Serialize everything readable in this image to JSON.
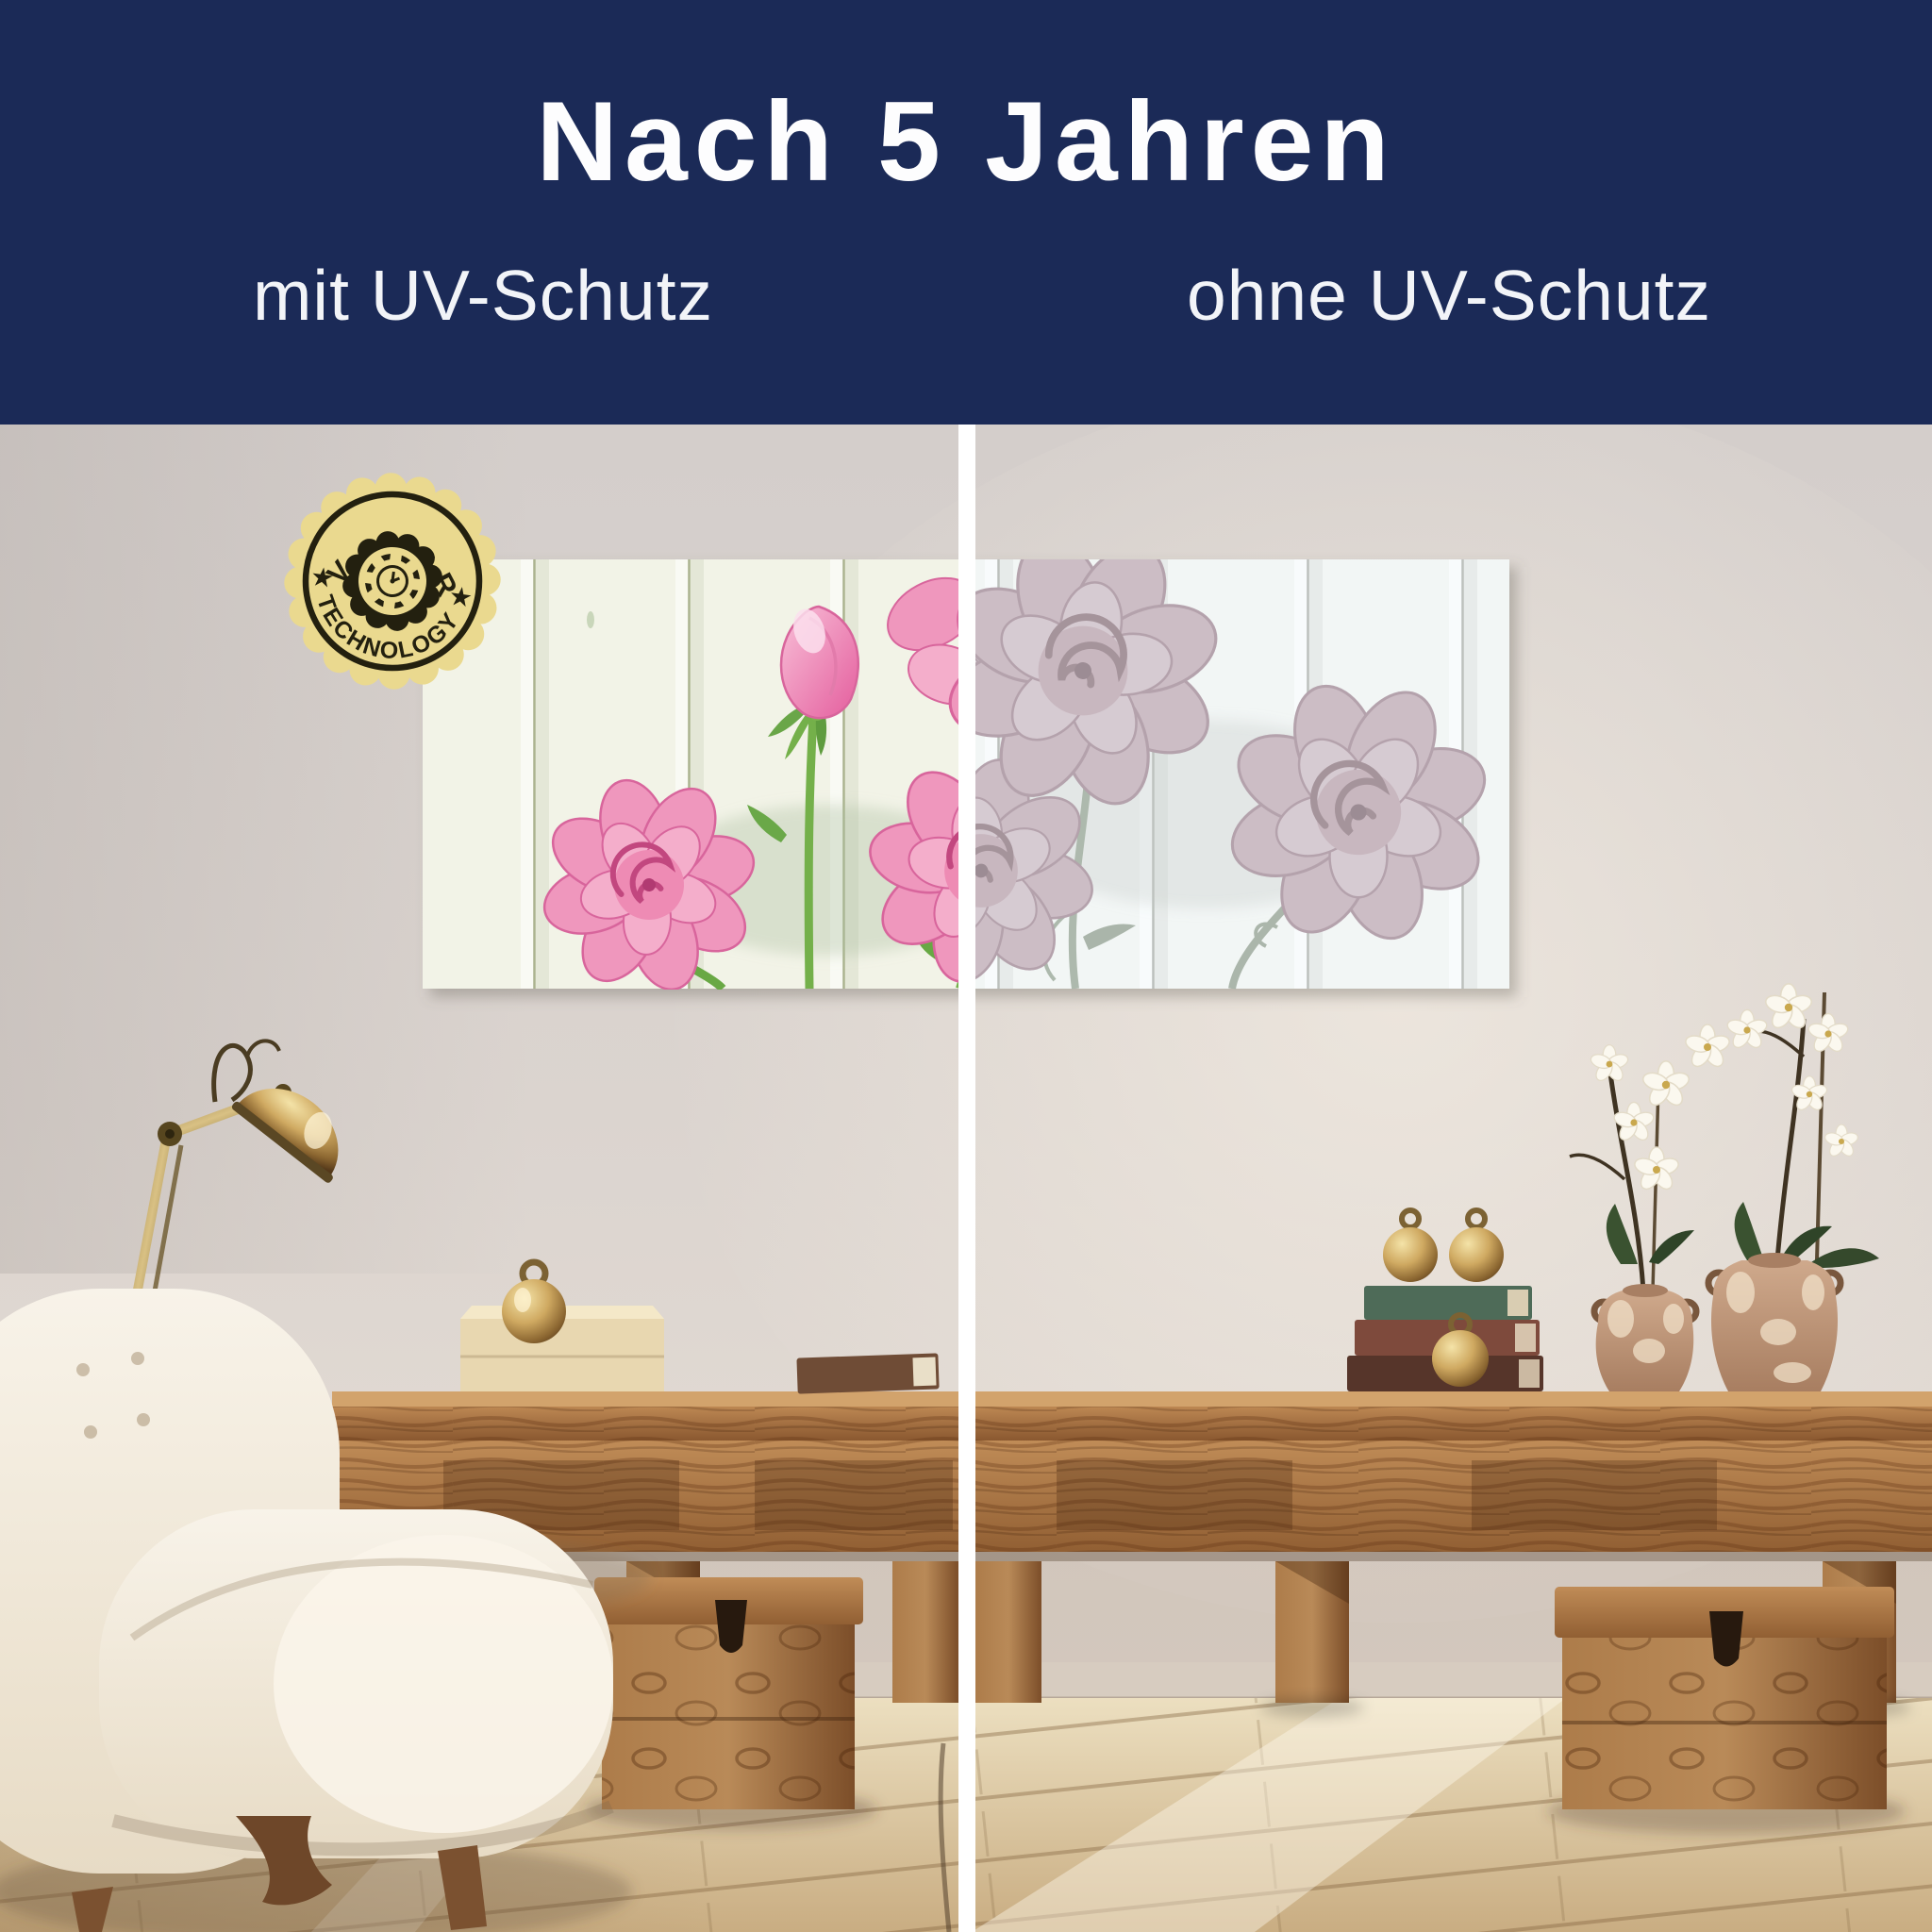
{
  "header": {
    "title": "Nach 5 Jahren",
    "left_label": "mit UV-Schutz",
    "right_label": "ohne UV-Schutz"
  },
  "badge": {
    "arc_top": "UV-GUARD",
    "arc_bottom": "TECHNOLOGY",
    "star_left": "★",
    "star_right": "★"
  },
  "colors": {
    "banner_bg": "#1b2a57",
    "banner_text": "#fdfdfe",
    "divider": "#ffffff",
    "badge_gold": "#ead98f",
    "badge_ink": "#23200f",
    "wall": "#d8d1cd",
    "floor_wood": "#dfcda8",
    "furniture_wood": "#9a6538",
    "chair_cream": "#f3ecdf",
    "brass": "#c9a55e",
    "canvas_ground": "#f2f3e7",
    "rose_pink_vibrant": "#ee92ba",
    "rose_pink_faded": "#e8d9de",
    "stem_green_vibrant": "#74b04a",
    "stem_green_faded": "#a9bb9f"
  }
}
